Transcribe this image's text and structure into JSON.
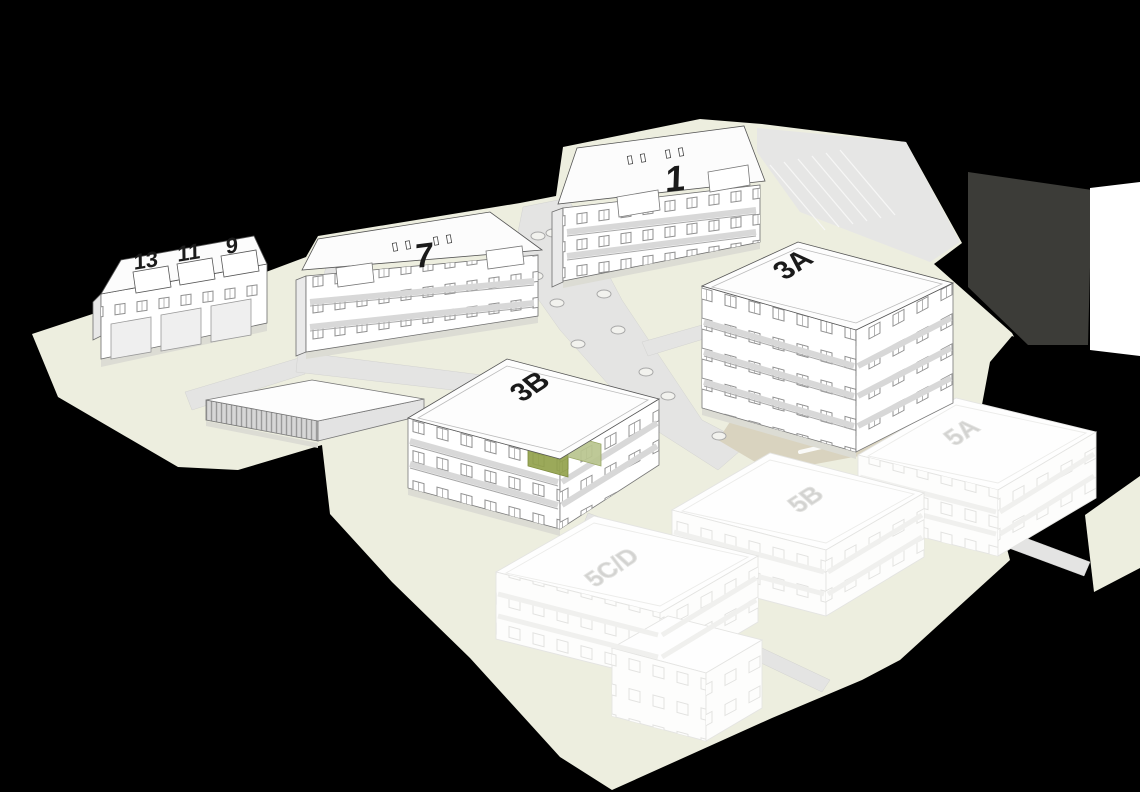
{
  "scene": {
    "background_color": "#000000",
    "ground_color": "#edeedf",
    "road_color": "#e4e4e3",
    "courtyard_color": "#d9d3bf",
    "building_fill": "#ffffff",
    "label_color": "#1a1a1a",
    "ghost_label_color": "#d3d3d1",
    "highlight_color_dark": "#93a24c",
    "highlight_color_light": "#b9c48e"
  },
  "buildings": {
    "existing": [
      {
        "label": "13"
      },
      {
        "label": "11"
      },
      {
        "label": "9"
      },
      {
        "label": "7"
      },
      {
        "label": "1"
      },
      {
        "label": "3A"
      },
      {
        "label": "3B"
      }
    ],
    "planned": [
      {
        "label": "5A"
      },
      {
        "label": "5B"
      },
      {
        "label": "5C/D"
      }
    ],
    "highlighted_unit": {
      "building": "3B"
    }
  }
}
